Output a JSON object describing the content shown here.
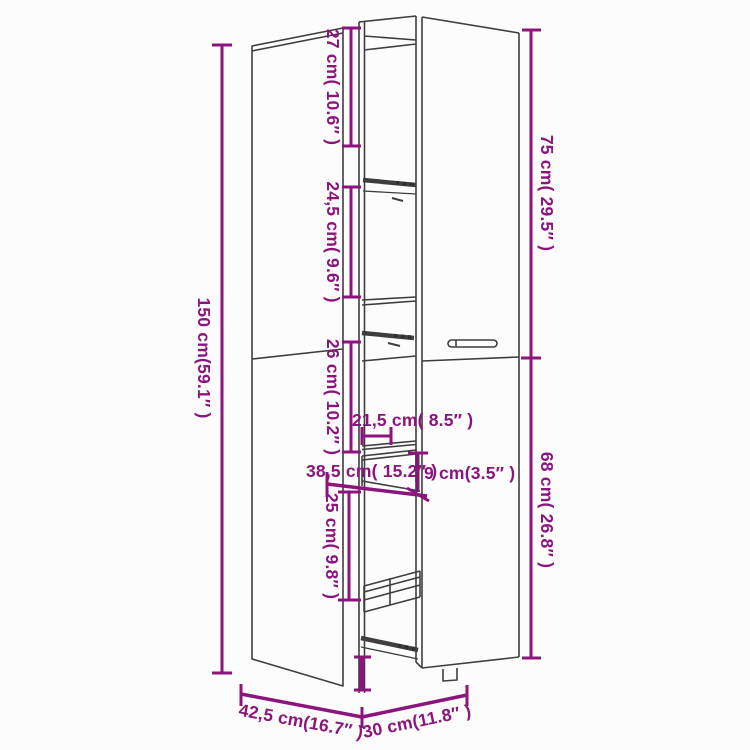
{
  "diagram": {
    "type": "furniture-dimension-diagram",
    "subject": "tall apothecary cabinet with pull-out drawer column"
  },
  "colors": {
    "dimension": "#8C147D",
    "outline": "#3E3E3E",
    "rail": "#2E2E2E",
    "background": "#FCFCFC"
  },
  "dimensions": {
    "total_height": {
      "label": "150 cm(59.1″ )"
    },
    "section_27": {
      "label": "27 cm( 10.6″ )"
    },
    "section_24_5": {
      "label": "24,5 cm( 9.6″ )"
    },
    "section_26": {
      "label": "26 cm( 10.2″ )"
    },
    "drawer_21_5": {
      "label": "21,5 cm( 8.5″ )"
    },
    "drawer_38_5": {
      "label": "38,5 cm( 15.2″ )"
    },
    "drawer_9": {
      "label": "9 cm(3.5″ )"
    },
    "section_25": {
      "label": "25 cm( 9.8″ )"
    },
    "upper_75": {
      "label": "75 cm( 29.5″ )"
    },
    "lower_68": {
      "label": "68 cm( 26.8″ )"
    },
    "depth_42_5": {
      "label": "42,5 cm(16.7″ )"
    },
    "width_30": {
      "label": "30 cm(11.8″ )"
    }
  }
}
